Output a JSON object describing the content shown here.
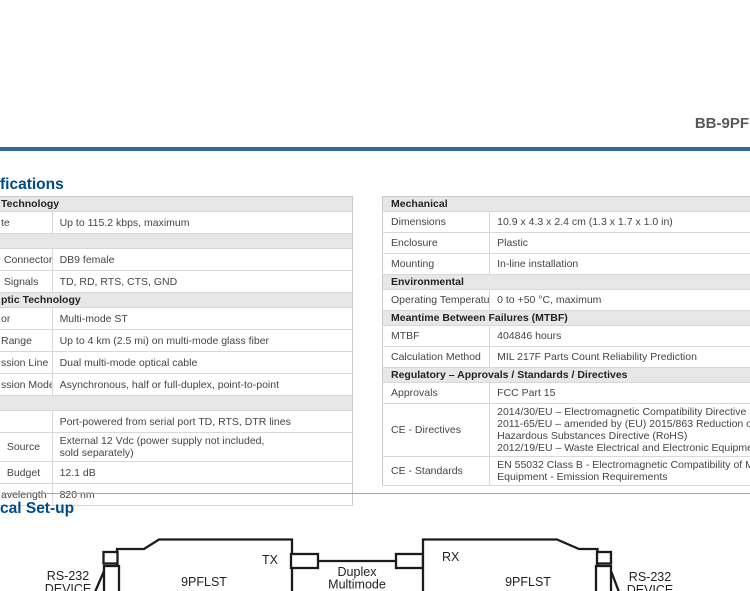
{
  "page": {
    "product_title": "BB-9PF",
    "colors": {
      "heading_blue": "#004b87",
      "rule_blue": "#30679f",
      "title_gray": "#58595b",
      "section_gray": "#e7e7e8"
    }
  },
  "headings": {
    "specifications": "fications",
    "typical_setup": "cal Set-up"
  },
  "left_table": {
    "rows": [
      {
        "type": "section",
        "label": "Technology"
      },
      {
        "type": "data",
        "label": "te",
        "value": "Up to 115.2 kbps, maximum"
      },
      {
        "type": "section",
        "label": ""
      },
      {
        "type": "data",
        "label": " Connector",
        "value": "DB9 female"
      },
      {
        "type": "data",
        "label": " Signals",
        "value": "TD, RD, RTS, CTS, GND"
      },
      {
        "type": "section",
        "label": "ptic Technology"
      },
      {
        "type": "data",
        "label": "or",
        "value": "Multi-mode ST"
      },
      {
        "type": "data",
        "label": "Range",
        "value": "Up to 4 km (2.5 mi) on multi-mode glass fiber"
      },
      {
        "type": "data",
        "label": "ssion Line",
        "value": "Dual multi-mode optical cable"
      },
      {
        "type": "data",
        "label": "ssion Mode",
        "value": "Asynchronous, half or full-duplex, point-to-point"
      },
      {
        "type": "section",
        "label": ""
      },
      {
        "type": "data",
        "label": "",
        "value": "Port-powered from serial port TD, RTS, DTR lines"
      },
      {
        "type": "data",
        "label": "  Source",
        "value": "External 12 Vdc (power supply not included,\nsold separately)"
      },
      {
        "type": "data",
        "label": "  Budget",
        "value": "12.1 dB"
      },
      {
        "type": "data",
        "label": "avelength",
        "value": "820 nm"
      }
    ]
  },
  "right_table": {
    "rows": [
      {
        "type": "section",
        "label": "Mechanical"
      },
      {
        "type": "data",
        "label": "Dimensions",
        "value": "10.9 x 4.3 x 2.4 cm (1.3 x 1.7 x 1.0 in)"
      },
      {
        "type": "data",
        "label": "Enclosure",
        "value": "Plastic"
      },
      {
        "type": "data",
        "label": "Mounting",
        "value": "In-line installation"
      },
      {
        "type": "section",
        "label": "Environmental"
      },
      {
        "type": "data",
        "label": "Operating Temperature",
        "value": "0 to +50 °C, maximum"
      },
      {
        "type": "section",
        "label": "Meantime Between Failures (MTBF)"
      },
      {
        "type": "data",
        "label": "MTBF",
        "value": "404846 hours"
      },
      {
        "type": "data",
        "label": "Calculation Method",
        "value": "MIL 217F Parts Count Reliability Prediction"
      },
      {
        "type": "section",
        "label": "Regulatory – Approvals / Standards / Directives"
      },
      {
        "type": "data",
        "label": "Approvals",
        "value": "FCC Part 15"
      },
      {
        "type": "data",
        "label": "CE - Directives",
        "value": "2014/30/EU – Electromagnetic Compatibility Directive (ECD)\n2011-65/EU – amended by (EU) 2015/863 Reduction of\nHazardous Substances Directive (RoHS)\n2012/19/EU – Waste Electrical and Electronic Equipment (WEEE)"
      },
      {
        "type": "data",
        "label": "CE - Standards",
        "value": "EN 55032 Class B - Electromagnetic Compatibility of Multimedia\nEquipment - Emission Requirements"
      }
    ]
  },
  "diagram": {
    "left_device_line1": "RS-232",
    "left_device_line2": "DEVICE",
    "left_converter": "9PFLST",
    "tx_label": "TX",
    "fiber_line1": "Duplex",
    "fiber_line2": "Multimode",
    "fiber_line3": "Fiber",
    "rx_label": "RX",
    "right_converter": "9PFLST",
    "right_device_line1": "RS-232",
    "right_device_line2": "DEVICE"
  }
}
